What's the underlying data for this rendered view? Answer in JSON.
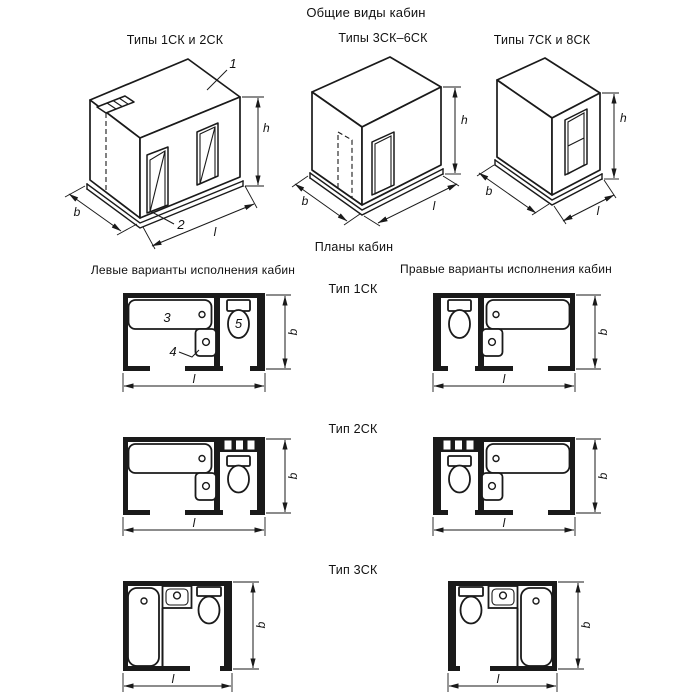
{
  "page": {
    "title": "Общие виды кабин",
    "plans_title": "Планы кабин",
    "left_column_header": "Левые варианты исполнения кабин",
    "right_column_header": "Правые варианты исполнения кабин",
    "ink_color": "#1a1a1a",
    "background_color": "#ffffff"
  },
  "general_views": [
    {
      "caption": "Типы 1СК и 2СК"
    },
    {
      "caption": "Типы 3СК–6СК"
    },
    {
      "caption": "Типы 7СК и 8СК"
    }
  ],
  "plan_rows": [
    {
      "type_label": "Тип 1СК"
    },
    {
      "type_label": "Тип 2СК"
    },
    {
      "type_label": "Тип 3СК"
    }
  ],
  "dim_labels": {
    "width": "b",
    "length": "l",
    "height": "h"
  },
  "callouts": {
    "roof_panel": "1",
    "base_panel": "2",
    "bath": "3",
    "washbasin": "4",
    "toilet": "5"
  }
}
